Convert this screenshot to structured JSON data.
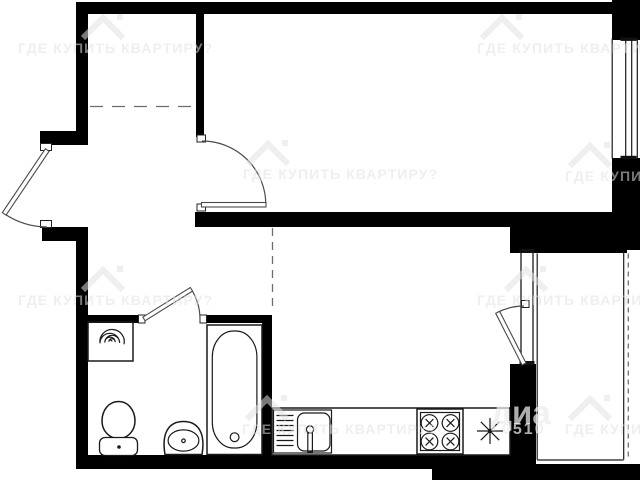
{
  "watermark": {
    "tile_text": "ГДЕ КУПИТЬ КВАРТИРУ?",
    "big_fragment": "диа",
    "digits_fragment": "0510",
    "icon": "house-roof-icon"
  },
  "colors": {
    "background": "#ffffff",
    "walls": "#000000",
    "fixture_lines": "#1a1a1a",
    "door_lines": "#4a4a4a",
    "watermark_gray_on_white": "#e2e2e2",
    "watermark_gray_on_black": "#a0a0a0"
  },
  "fixtures": {
    "entrance_door": "exterior-swing-door",
    "hall_door": "interior-swing-door",
    "bathroom_door": "interior-swing-door",
    "balcony_block": "balcony-door-and-window",
    "window": "double-line-window",
    "washing_machine": "box-with-spiral-drum",
    "toilet": "bowl-and-tank",
    "pedestal_sink": "oval-basin",
    "bathtub": "rectangular-tub",
    "kitchen_sink": "basin-with-drainboard-and-faucet",
    "stove": "four-burner-cooktop",
    "light_symbol": "eight-ray-asterisk"
  }
}
